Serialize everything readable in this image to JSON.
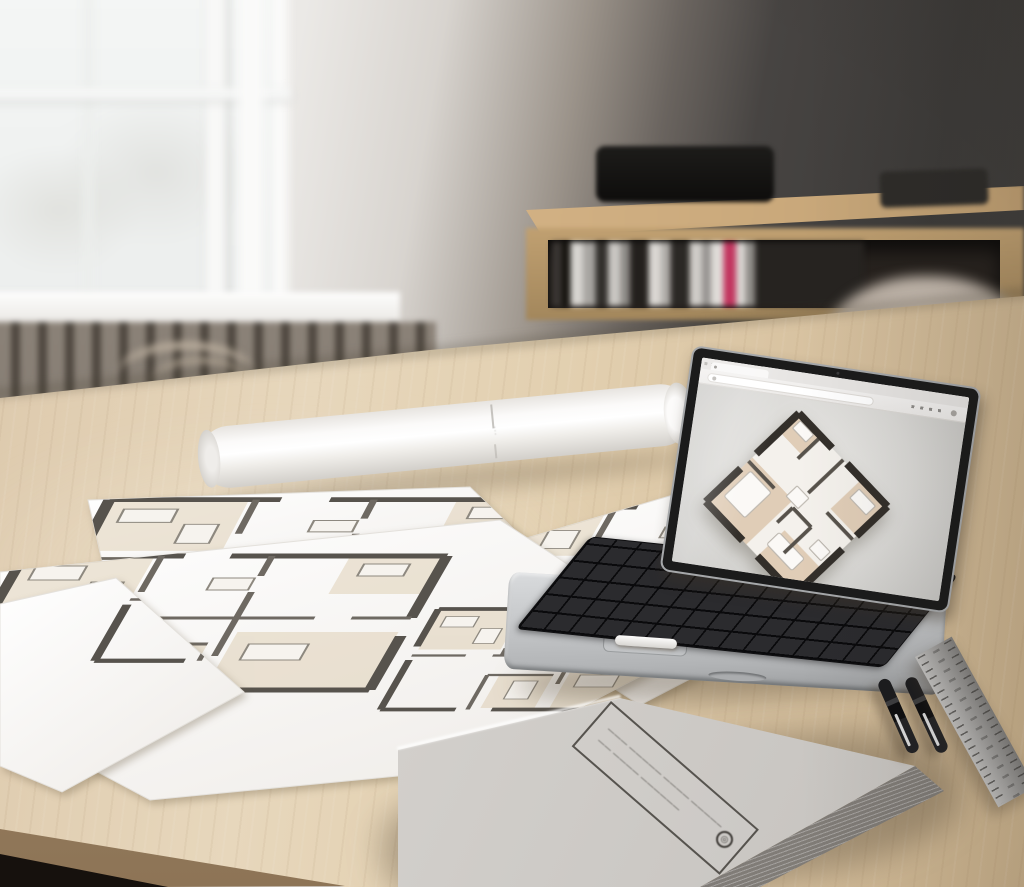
{
  "scene": {
    "subject": "Architect's workspace: light wooden table with printed floor plans, a rolled blueprint, a laptop showing a 3D floor plan in a browser, a hardcover book, two pens, a steel ruler, window and sideboard with books in the background",
    "width_px": 1024,
    "height_px": 887
  },
  "palette": {
    "wall_left": "#f1f0ee",
    "wall_dark": "#3d3b39",
    "table_wood_light": "#e7d7bc",
    "table_wood_dark": "#cbb28c",
    "sideboard_wood": "#c0a071",
    "paper": "#fdfcfb",
    "plan_wall_line": "#57534d",
    "plan_room_fill": "#d9c7a8",
    "laptop_body": "#c6c8ca",
    "laptop_keys": "#2b2b2e",
    "screen_chrome": "#f6f5f4",
    "book_cover": "#d4d1cd",
    "accent_book_spine_pink": "#c2355f",
    "pen_black": "#161618",
    "ruler_steel": "#9c9a97"
  },
  "blueprint_roll": {
    "seam_mark": "···"
  },
  "book": {
    "label_line1": "——— ————— ———— ——————",
    "label_line2": "—— ———— ——————",
    "logo_glyph": "◎"
  },
  "laptop_screen": {
    "content": "3D rendered apartment floor plan viewed at an angle in a light browser window"
  }
}
